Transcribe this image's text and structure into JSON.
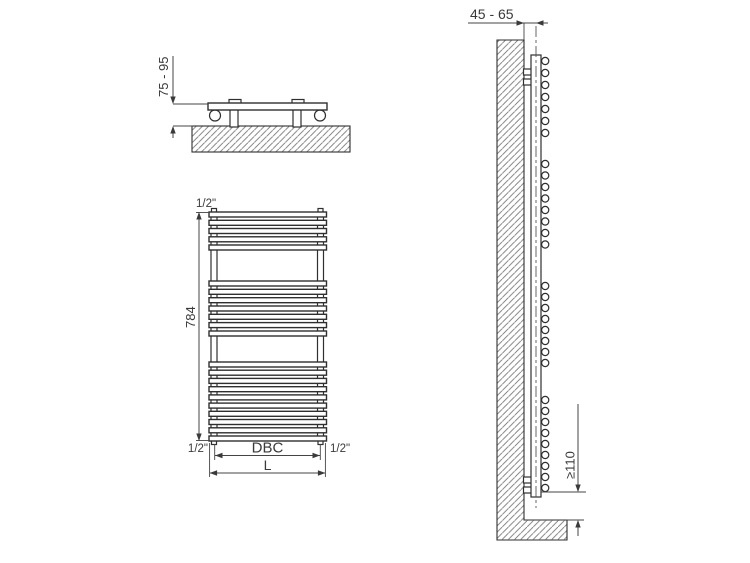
{
  "diagram": {
    "description": "Technical installation drawing of a ladder towel radiator: top view, front view and side view with mounting dimensions",
    "top_view": {
      "wall_distance_label": "75 - 95"
    },
    "front_view": {
      "top_connection_label": "1/2\"",
      "height_label": "784",
      "bottom_left_connection_label": "1/2\"",
      "bottom_right_connection_label": "1/2\"",
      "centers_distance_label": "DBC",
      "overall_width_label": "L",
      "bar_groups": [
        5,
        7,
        10
      ]
    },
    "side_view": {
      "wall_depth_label": "45 - 65",
      "floor_clearance_label": "≥110",
      "bar_end_groups": [
        7,
        8,
        8,
        9
      ]
    },
    "colors": {
      "line": "#2f2f2f",
      "dimension": "#444444",
      "hatch": "#777777",
      "background": "#ffffff"
    }
  }
}
